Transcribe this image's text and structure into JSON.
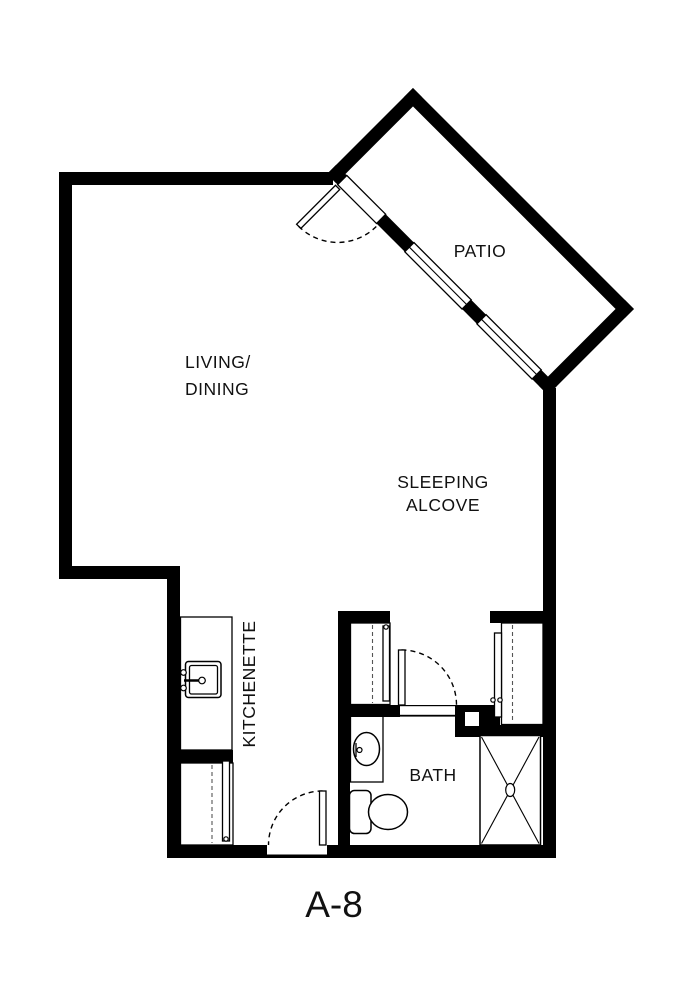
{
  "title": "A-8",
  "rooms": {
    "living_dining": {
      "line1": "LIVING/",
      "line2": "DINING"
    },
    "patio": {
      "label": "PATIO"
    },
    "sleeping_alcove": {
      "line1": "SLEEPING",
      "line2": "ALCOVE"
    },
    "kitchenette": {
      "label": "KITCHENETTE"
    },
    "bath": {
      "label": "BATH"
    }
  },
  "colors": {
    "wall": "#000000",
    "background": "#ffffff",
    "label_text": "#111111"
  }
}
